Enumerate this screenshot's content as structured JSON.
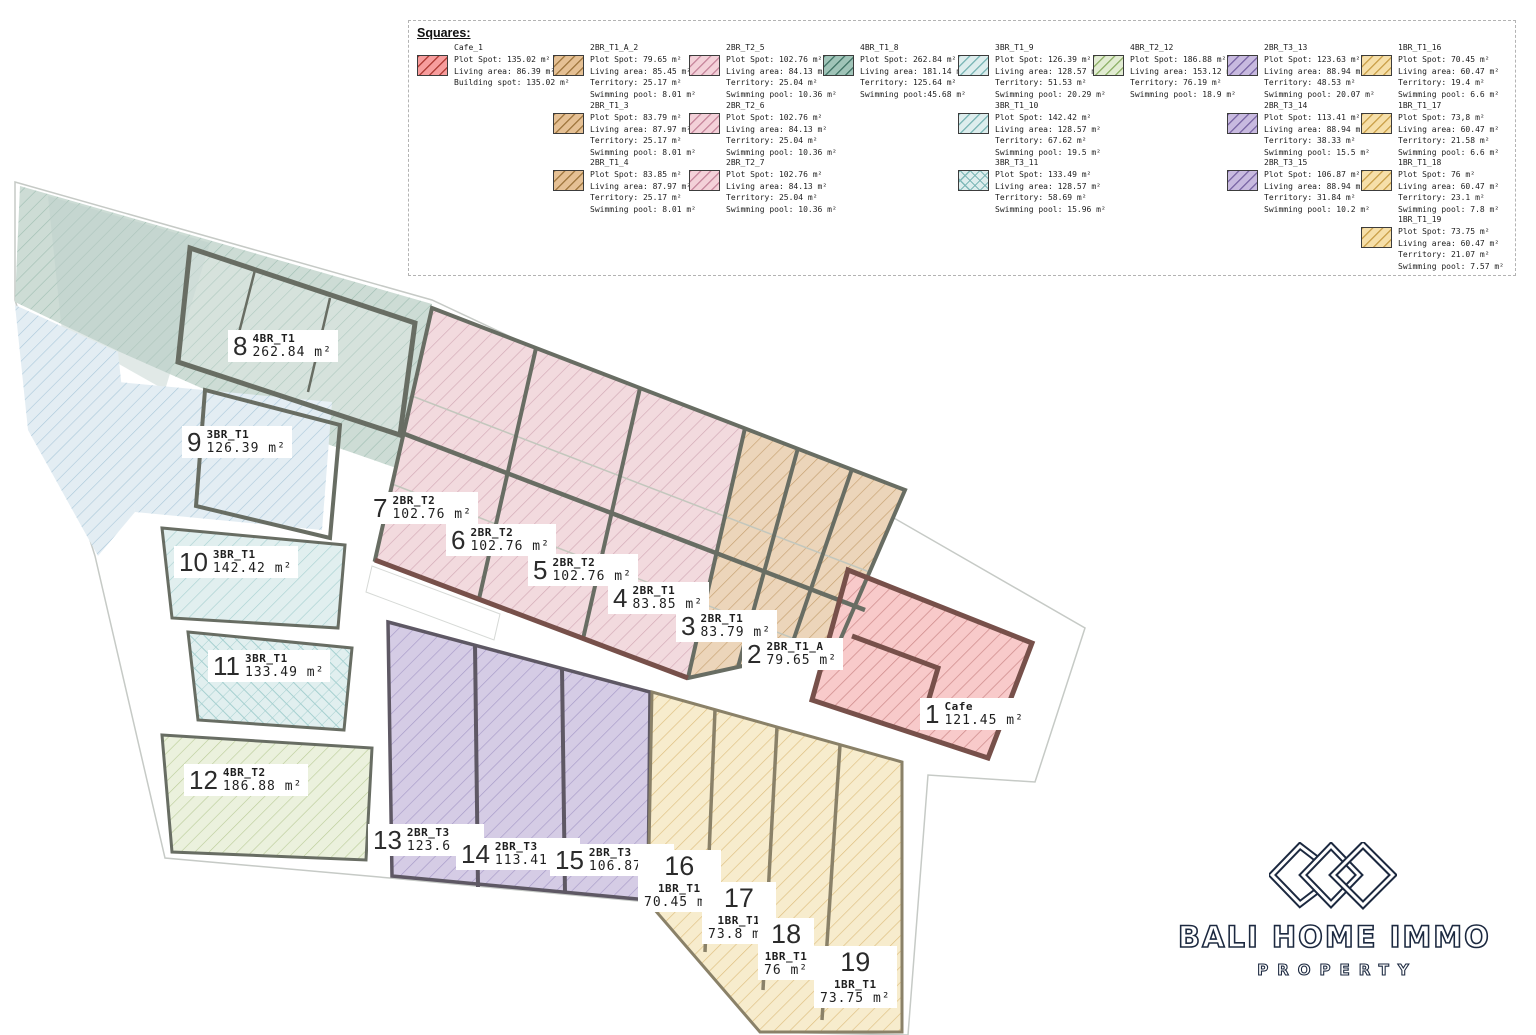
{
  "legend": {
    "title": "Squares:",
    "items": [
      {
        "name": "Cafe_1",
        "lines": [
          "Plot Spot: 135.02 m²",
          "Living area: 86.39 m²",
          "Building spot: 135.02 m²"
        ]
      },
      {
        "name": "2BR_T1_A_2",
        "lines": [
          "Plot Spot: 79.65 m²",
          "Living area: 85.45 m²",
          "Territory: 25.17 m²",
          "Swimming pool: 8.01 m²"
        ]
      },
      {
        "name": "2BR_T1_3",
        "lines": [
          "Plot Spot: 83.79 m²",
          "Living area: 87.97 m²",
          "Territory: 25.17 m²",
          "Swimming pool: 8.01 m²"
        ]
      },
      {
        "name": "2BR_T1_4",
        "lines": [
          "Plot Spot: 83.85 m²",
          "Living area: 87.97 m²",
          "Territory: 25.17 m²",
          "Swimming pool: 8.01 m²"
        ]
      },
      {
        "name": "2BR_T2_5",
        "lines": [
          "Plot Spot: 102.76 m²",
          "Living area: 84.13 m²",
          "Territory: 25.04 m²",
          "Swimming pool: 10.36 m²"
        ]
      },
      {
        "name": "2BR_T2_6",
        "lines": [
          "Plot Spot: 102.76 m²",
          "Living area: 84.13 m²",
          "Territory: 25.04 m²",
          "Swimming pool: 10.36 m²"
        ]
      },
      {
        "name": "2BR_T2_7",
        "lines": [
          "Plot Spot: 102.76 m²",
          "Living area: 84.13 m²",
          "Territory: 25.04 m²",
          "Swimming pool: 10.36 m²"
        ]
      },
      {
        "name": "4BR_T1_8",
        "lines": [
          "Plot Spot: 262.84 m²",
          "Living area: 181.14 m²",
          "Territory: 125.64 m²",
          "Swimming pool:45.68 m²"
        ]
      },
      {
        "name": "3BR_T1_9",
        "lines": [
          "Plot Spot: 126.39 m²",
          "Living area: 128.57 m²",
          "Territory: 51.53 m²",
          "Swimming pool: 20.29 m²"
        ]
      },
      {
        "name": "3BR_T1_10",
        "lines": [
          "Plot Spot: 142.42 m²",
          "Living area: 128.57 m²",
          "Territory: 67.62 m²",
          "Swimming pool: 19.5 m²"
        ]
      },
      {
        "name": "3BR_T3_11",
        "lines": [
          "Plot Spot: 133.49 m²",
          "Living area: 128.57 m²",
          "Territory: 58.69 m²",
          "Swimming pool: 15.96 m²"
        ]
      },
      {
        "name": "4BR_T2_12",
        "lines": [
          "Plot Spot: 186.88 m²",
          "Living area: 153.12 m²",
          "Territory: 76.19 m²",
          "Swimming pool: 18.9 m²"
        ]
      },
      {
        "name": "2BR_T3_13",
        "lines": [
          "Plot Spot: 123.63 m²",
          "Living area: 88.94 m²",
          "Territory: 48.53 m²",
          "Swimming pool: 20.07 m²"
        ]
      },
      {
        "name": "2BR_T3_14",
        "lines": [
          "Plot Spot: 113.41 m²",
          "Living area: 88.94 m²",
          "Territory: 38.33 m²",
          "Swimming pool: 15.5 m²"
        ]
      },
      {
        "name": "2BR_T3_15",
        "lines": [
          "Plot Spot: 106.87 m²",
          "Living area: 88.94 m²",
          "Territory: 31.84 m²",
          "Swimming pool: 10.2 m²"
        ]
      },
      {
        "name": "1BR_T1_16",
        "lines": [
          "Plot Spot: 70.45 m²",
          "Living area: 60.47 m²",
          "Territory: 19.4 m²",
          "Swimming pool: 6.6 m²"
        ]
      },
      {
        "name": "1BR_T1_17",
        "lines": [
          "Plot Spot: 73,8 m²",
          "Living area: 60.47 m²",
          "Territory: 21.58 m²",
          "Swimming pool: 6.6 m²"
        ]
      },
      {
        "name": "1BR_T1_18",
        "lines": [
          "Plot Spot: 76 m²",
          "Living area: 60.47 m²",
          "Territory: 23.1 m²",
          "Swimming pool: 7.8 m²"
        ]
      },
      {
        "name": "1BR_T1_19",
        "lines": [
          "Plot Spot: 73.75 m²",
          "Living area: 60.47 m²",
          "Territory: 21.07 m²",
          "Swimming pool: 7.57 m²"
        ]
      }
    ]
  },
  "units": [
    {
      "number": "1",
      "type": "Cafe",
      "area": "121.45 m²"
    },
    {
      "number": "2",
      "type": "2BR_T1_A",
      "area": "79.65 m²"
    },
    {
      "number": "3",
      "type": "2BR_T1",
      "area": "83.79 m²"
    },
    {
      "number": "4",
      "type": "2BR_T1",
      "area": "83.85 m²"
    },
    {
      "number": "5",
      "type": "2BR_T2",
      "area": "102.76 m²"
    },
    {
      "number": "6",
      "type": "2BR_T2",
      "area": "102.76 m²"
    },
    {
      "number": "7",
      "type": "2BR_T2",
      "area": "102.76 m²"
    },
    {
      "number": "8",
      "type": "4BR_T1",
      "area": "262.84 m²"
    },
    {
      "number": "9",
      "type": "3BR_T1",
      "area": "126.39 m²"
    },
    {
      "number": "10",
      "type": "3BR_T1",
      "area": "142.42 m²"
    },
    {
      "number": "11",
      "type": "3BR_T1",
      "area": "133.49 m²"
    },
    {
      "number": "12",
      "type": "4BR_T2",
      "area": "186.88 m²"
    },
    {
      "number": "13",
      "type": "2BR_T3",
      "area": "123.6 m²"
    },
    {
      "number": "14",
      "type": "2BR_T3",
      "area": "113.41 m²"
    },
    {
      "number": "15",
      "type": "2BR_T3",
      "area": "106.87 m²"
    },
    {
      "number": "16",
      "type": "1BR_T1",
      "area": "70.45 m²"
    },
    {
      "number": "17",
      "type": "1BR_T1",
      "area": "73.8 m²"
    },
    {
      "number": "18",
      "type": "1BR_T1",
      "area": "76 m²"
    },
    {
      "number": "19",
      "type": "1BR_T1",
      "area": "73.75 m²"
    }
  ],
  "logo": {
    "brand": "BALI HOME IMMO",
    "tagline": "PROPERTY"
  },
  "colors": {
    "navy": "#1c2940",
    "lg-cafe-fill": "#f79d9d",
    "lg-cafe-hatch": "#b2403a",
    "lg-tan-fill": "#e5c094",
    "lg-tan-hatch": "#a47b43",
    "lg-pink-fill": "#f3d1d9",
    "lg-pink-hatch": "#c98ba0",
    "lg-teal-fill": "#a0c4b8",
    "lg-teal-hatch": "#47796b",
    "lg-cyan-fill": "#ddeded",
    "lg-cyan-hatch": "#7fb8b8",
    "lg-green-fill": "#e2ecd2",
    "lg-green-hatch": "#93b46d",
    "lg-purple-fill": "#c8badf",
    "lg-purple-hatch": "#7f6ba8",
    "lg-yellow-fill": "#f6dfa9",
    "lg-yellow-hatch": "#cda44f",
    "plan-cafe-fill": "#f8caca",
    "plan-cafe-hatch": "#cf8d8d",
    "plan-tan-fill": "#ecd5ba",
    "plan-tan-hatch": "#c6a171",
    "plan-pink-fill": "#f2dade",
    "plan-pink-hatch": "#d3aab6",
    "plan-teal-fill": "#cddcd5",
    "plan-teal-hatch": "#9fbeb2",
    "plan-teal-dark": "#bccfc9",
    "plan-blue-fill": "#e3edf3",
    "plan-blue-hatch": "#abc8da",
    "plan-cyan-fill": "#e1efef",
    "plan-cyan-hatch": "#a6d0d0",
    "plan-green-fill": "#ebf1dd",
    "plan-green-hatch": "#b9cc97",
    "plan-purple-fill": "#d5cce5",
    "plan-purple-hatch": "#a79ac8",
    "plan-yellow-fill": "#f7eccd",
    "plan-yellow-hatch": "#debf7f",
    "wall": "#686d63",
    "wall-maroon": "#77504a",
    "boundary": "#c6cac6"
  }
}
